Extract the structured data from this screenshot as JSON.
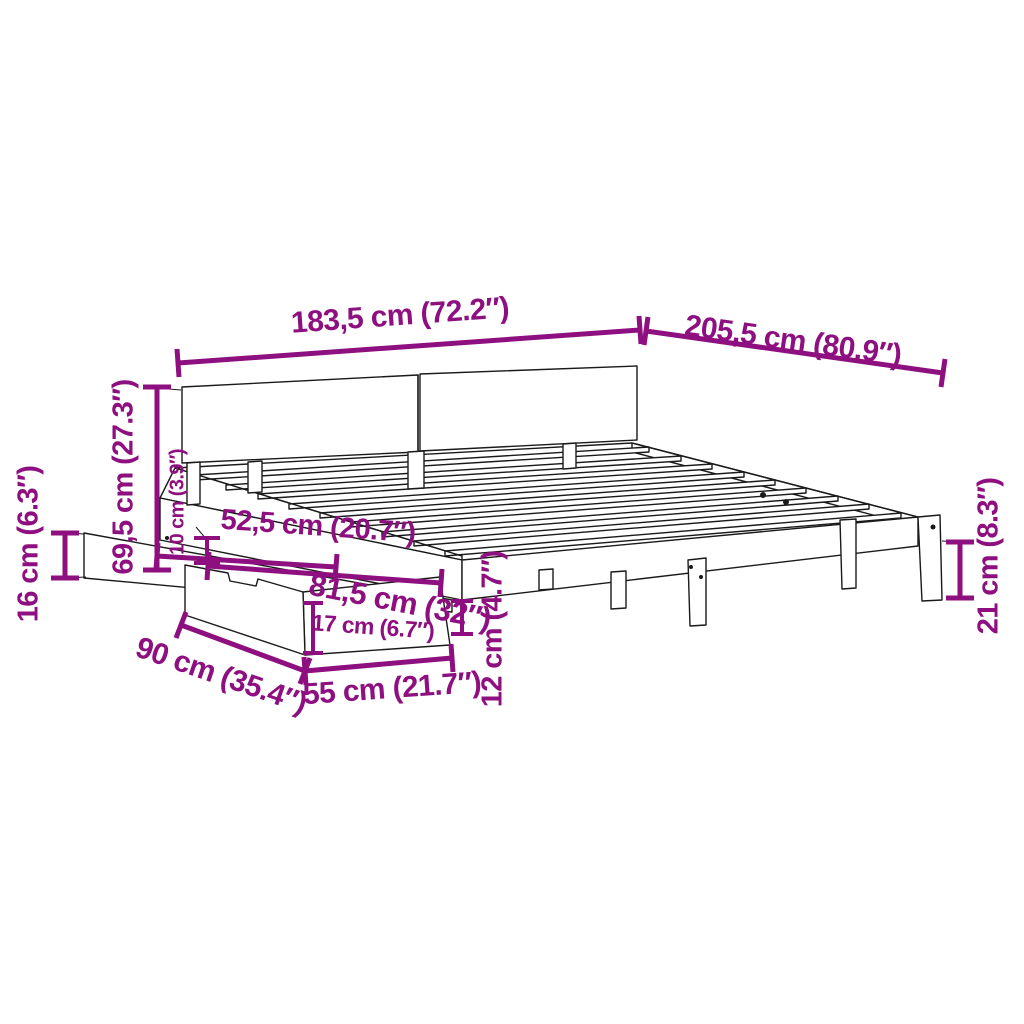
{
  "diagram": {
    "kind": "product-dimension-diagram",
    "subject": "bed-frame-with-headboard-and-storage-drawer",
    "accent_color": "#8E0F7F",
    "line_color": "#1A1A1A",
    "background_color": "#FFFFFF"
  },
  "dimensions": {
    "headboard_width": {
      "label": "183,5 cm (72.2″)"
    },
    "bed_length": {
      "label": "205,5 cm (80.9″)"
    },
    "headboard_height": {
      "label": "69,5 cm (27.3″)"
    },
    "drawer_side_height": {
      "label": "16 cm (6.3″)"
    },
    "rail_thickness": {
      "label": "10 cm (3.9″)"
    },
    "drawer_inner_depth": {
      "label": "52,5 cm (20.7″)"
    },
    "drawer_total_depth": {
      "label": "81,5 cm (32″)"
    },
    "drawer_front_height": {
      "label": "17 cm (6.7″)"
    },
    "drawer_width": {
      "label": "90 cm (35.4″)"
    },
    "drawer_depth": {
      "label": "55 cm (21.7″)"
    },
    "rail_height": {
      "label": "12 cm (4.7″)"
    },
    "leg_height": {
      "label": "21 cm (8.3″)"
    }
  }
}
